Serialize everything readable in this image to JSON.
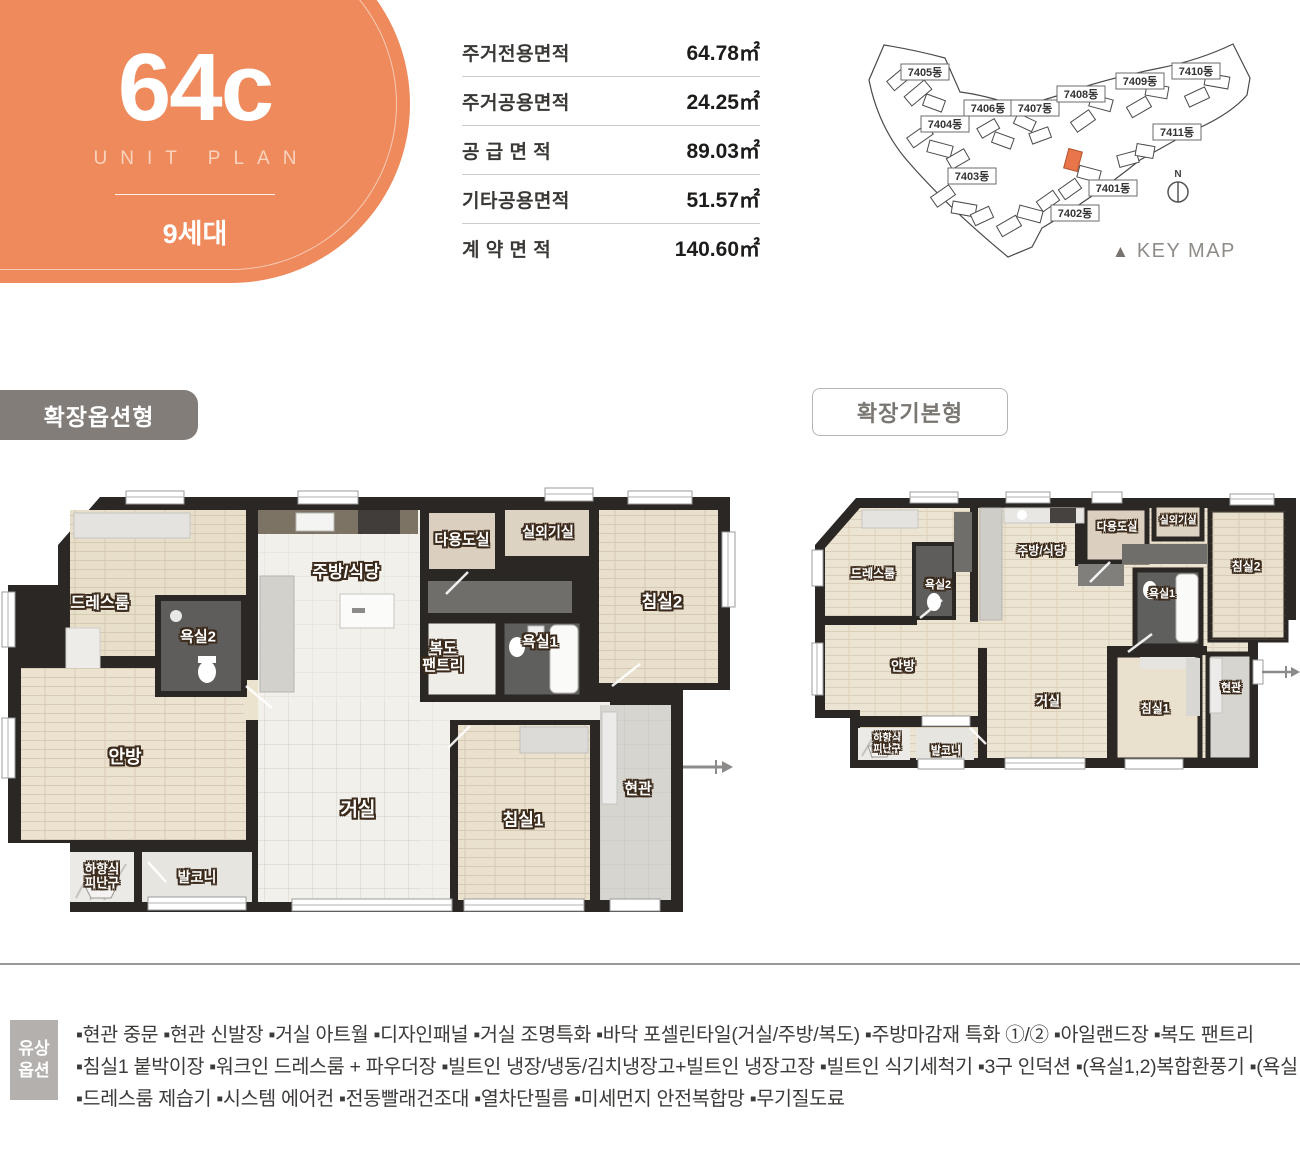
{
  "unit": {
    "code": "64c",
    "subtitle": "UNIT PLAN",
    "households": "9세대",
    "accent_color": "#ee8a5c"
  },
  "area_table": {
    "rows": [
      {
        "label": "주거전용면적",
        "value": "64.78㎡"
      },
      {
        "label": "주거공용면적",
        "value": "24.25㎡"
      },
      {
        "label": "공 급 면 적",
        "value": "89.03㎡"
      },
      {
        "label": "기타공용면적",
        "value": "51.57㎡"
      },
      {
        "label": "계 약 면 적",
        "value": "140.60㎡"
      }
    ]
  },
  "key_map": {
    "caption": "KEY MAP",
    "north_label": "N",
    "highlight_color": "#e8764a",
    "buildings": [
      {
        "label": "7401동"
      },
      {
        "label": "7402동"
      },
      {
        "label": "7403동"
      },
      {
        "label": "7404동"
      },
      {
        "label": "7405동"
      },
      {
        "label": "7406동"
      },
      {
        "label": "7407동"
      },
      {
        "label": "7408동"
      },
      {
        "label": "7409동"
      },
      {
        "label": "7410동"
      },
      {
        "label": "7411동"
      }
    ]
  },
  "plans": [
    {
      "title": "확장옵션형",
      "rooms": {
        "dressroom": "드레스룸",
        "bath2": "욕실2",
        "kitchen": "주방/식당",
        "utility": "다용도실",
        "ac_room": "실외기실",
        "bedroom2": "침실2",
        "pantry": "복도\n팬트리",
        "bath1": "욕실1",
        "master": "안방",
        "living": "거실",
        "bedroom1": "침실1",
        "entrance": "현관",
        "escape_hatch": "하향식\n피난구",
        "balcony": "발코니"
      }
    },
    {
      "title": "확장기본형",
      "rooms": {
        "dressroom": "드레스룸",
        "bath2": "욕실2",
        "kitchen": "주방/식당",
        "utility": "다용도실",
        "ac_room": "실외기실",
        "bedroom2": "침실2",
        "bath1": "욕실1",
        "master": "안방",
        "living": "거실",
        "bedroom1": "침실1",
        "entrance": "현관",
        "escape_hatch": "하향식\n피난구",
        "balcony": "발코니"
      }
    }
  ],
  "options": {
    "label": "유상\n옵션",
    "lines": [
      "▪현관 중문   ▪현관 신발장   ▪거실 아트월   ▪디자인패널   ▪거실 조명특화   ▪바닥 포셀린타일(거실/주방/복도)   ▪주방마감재 특화 ①/②   ▪아일랜드장   ▪복도 팬트리",
      "▪침실1 붙박이장   ▪워크인 드레스룸 + 파우더장   ▪빌트인 냉장/냉동/김치냉장고+빌트인 냉장고장   ▪빌트인 식기세척기   ▪3구 인덕션   ▪(욕실1,2)복합환풍기   ▪(욕실1)비데",
      "▪드레스룸 제습기   ▪시스템 에어컨   ▪전동빨래건조대   ▪열차단필름   ▪미세먼지 안전복합망   ▪무기질도료"
    ]
  }
}
